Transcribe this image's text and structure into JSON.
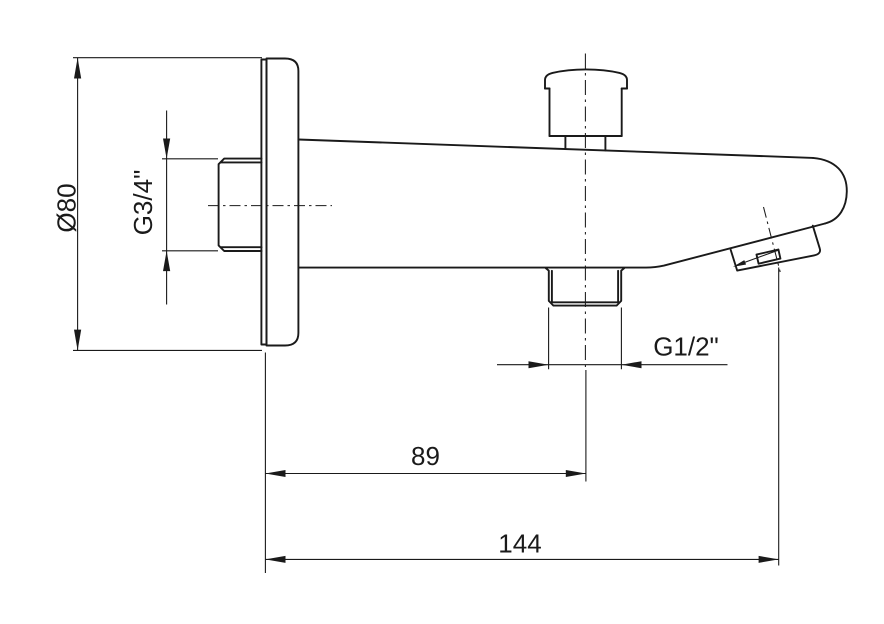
{
  "drawing": {
    "labels": {
      "plate_diameter": "Ø80",
      "inlet_thread": "G3/4\"",
      "outlet_thread": "G1/2\"",
      "plate_to_outlet_axis": "89",
      "overall_projection": "144"
    },
    "colors": {
      "line": "#1a1a1a",
      "background": "#ffffff"
    }
  }
}
